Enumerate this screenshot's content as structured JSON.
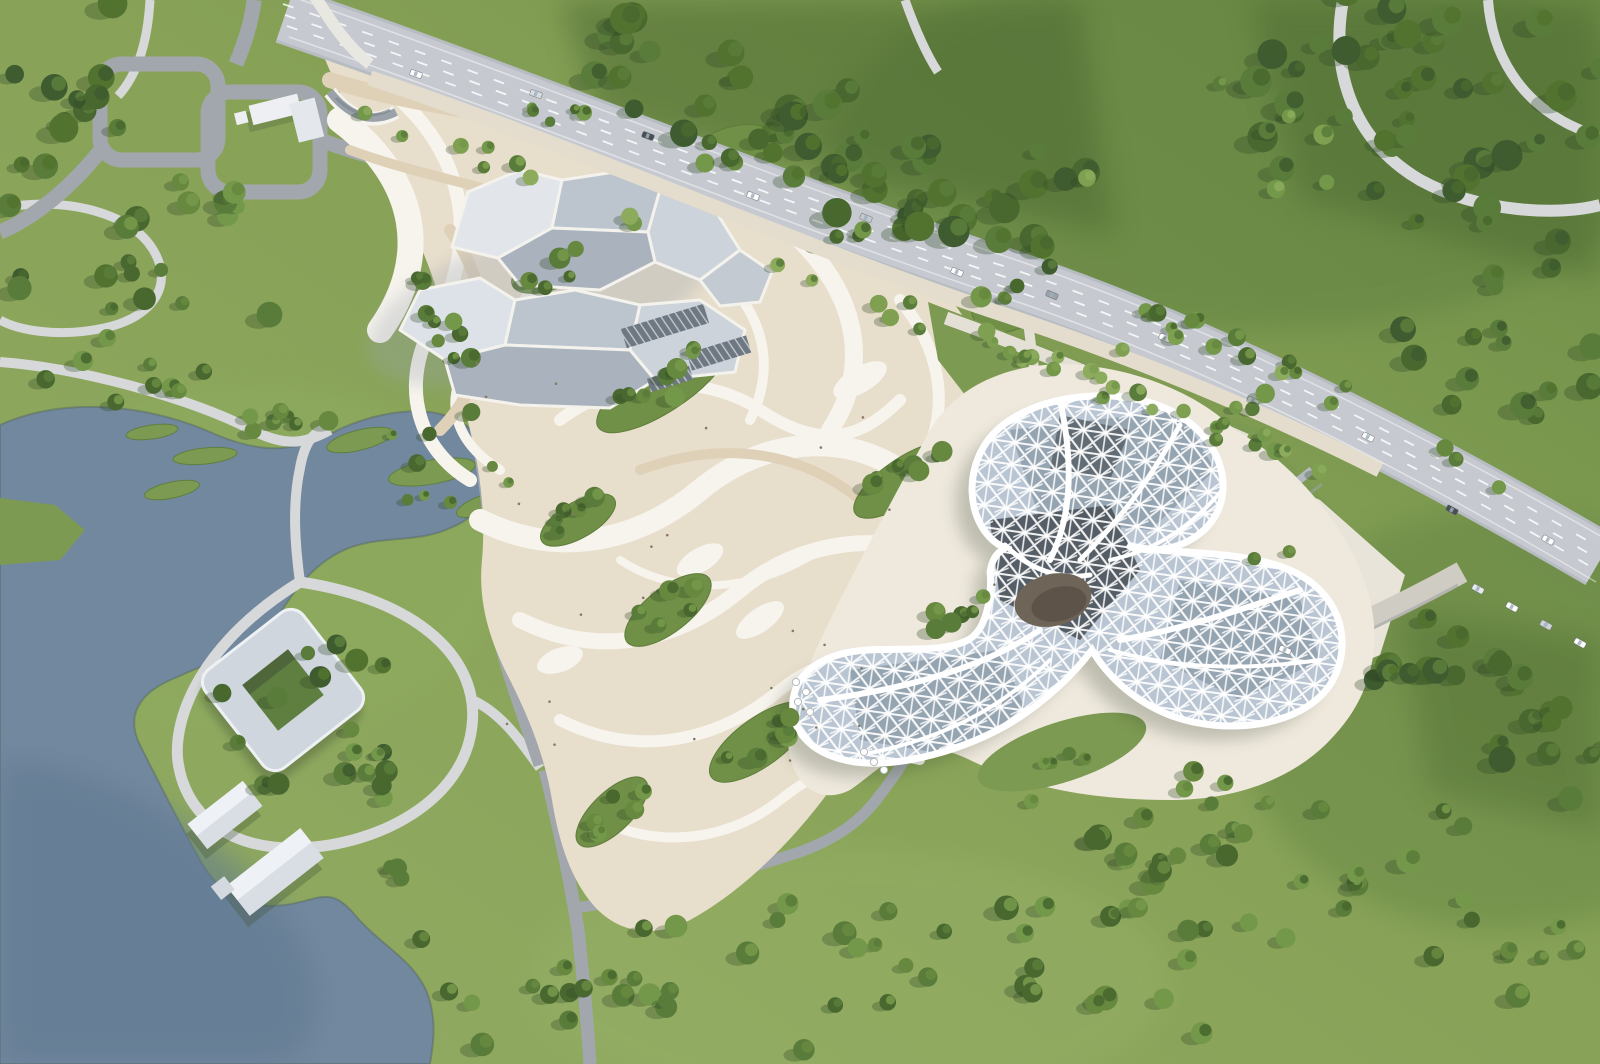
{
  "scene": {
    "type": "aerial-architectural-rendering",
    "description": "Bird's-eye masterplan rendering: park with lake and winding paths on the left, swirling cream-and-white plaza with rock-like grey pavilions in the centre, a white lattice-roof flower-shaped building on the right, and a tree-lined highway crossing diagonally with dense forest beyond.",
    "text_content": "none — image contains no readable text, labels or UI"
  },
  "colors": {
    "grass_base": "#87a257",
    "grass_light": "#9ab36a",
    "grass_dark": "#7d9a52",
    "meadow_dark": "#5f8040",
    "forest_floor": "#46632f",
    "tree_dark": "#48682f",
    "tree_mid": "#5a7c3b",
    "tree_light": "#74984a",
    "tree_pale": "#8cab5c",
    "tree_shadow": "#2f4526",
    "water": "#72889e",
    "water_deep": "#5f7890",
    "highway": "#c6cad0",
    "highway_casing": "#b7bcc2",
    "lane_marking": "#ffffff",
    "asphalt": "#a2a7ad",
    "path_light": "#d6d8d9",
    "sidewalk_cream": "#e4ddcd",
    "plaza_cream": "#e8decc",
    "plaza_tan": "#dfd1b8",
    "plaza_white": "#f7f4ed",
    "pavilion_top": "#e2e6eb",
    "pavilion_side": "#bcc4cd",
    "pavilion_shade": "#a9b2bd",
    "building_white": "#ffffff",
    "glass_base": "#b9c5d2",
    "glass_mid": "#8e9dac",
    "glass_dark": "#4a525a",
    "courtyard": "#6e6458",
    "apron_cream": "#efe9dd",
    "dropoff_pale": "#e9e4d9",
    "people_dot": "#857a68"
  },
  "scene_gen": {
    "seed": 7,
    "palettes": {
      "dark": [
        "#3e5c2f",
        "#48682f",
        "#52732f",
        "#5a7c3b"
      ],
      "mixed": [
        "#5a7c3b",
        "#48682f",
        "#74984a",
        "#67883f"
      ],
      "light": [
        "#74984a",
        "#8cab5c",
        "#5a7c3b",
        "#7ea050"
      ]
    },
    "tree_regions": [
      {
        "t": "band",
        "x1": 60,
        "y1": 0,
        "x2": 60,
        "y2": 300,
        "w": 120,
        "n": 16,
        "p": "dark",
        "r0": 8,
        "r1": 15
      },
      {
        "t": "blob",
        "cx": 200,
        "cy": 265,
        "rx": 95,
        "ry": 85,
        "n": 14,
        "p": "mixed",
        "r0": 7,
        "r1": 13
      },
      {
        "t": "band",
        "x1": 560,
        "y1": 50,
        "x2": 1080,
        "y2": 230,
        "w": 130,
        "n": 52,
        "p": "dark",
        "r0": 8,
        "r1": 16
      },
      {
        "t": "blob",
        "cx": 1420,
        "cy": 110,
        "rx": 200,
        "ry": 130,
        "n": 40,
        "p": "dark",
        "r0": 8,
        "r1": 16
      },
      {
        "t": "blob",
        "cx": 1530,
        "cy": 330,
        "rx": 130,
        "ry": 95,
        "n": 18,
        "p": "dark",
        "r0": 8,
        "r1": 14
      },
      {
        "t": "blob",
        "cx": 1210,
        "cy": 140,
        "rx": 150,
        "ry": 90,
        "n": 7,
        "p": "light",
        "r0": 7,
        "r1": 11
      },
      {
        "t": "band",
        "x1": 1060,
        "y1": 262,
        "x2": 1560,
        "y2": 505,
        "w": 34,
        "n": 15,
        "p": "mixed",
        "r0": 6,
        "r1": 10
      },
      {
        "t": "band",
        "x1": 360,
        "y1": 112,
        "x2": 1330,
        "y2": 468,
        "w": 26,
        "n": 30,
        "p": "light",
        "r0": 5,
        "r1": 9
      },
      {
        "t": "band",
        "x1": 150,
        "y1": 398,
        "x2": 330,
        "y2": 432,
        "w": 30,
        "n": 9,
        "p": "mixed",
        "r0": 6,
        "r1": 10
      },
      {
        "t": "blob",
        "cx": 432,
        "cy": 470,
        "rx": 85,
        "ry": 42,
        "n": 8,
        "p": "mixed",
        "r0": 5,
        "r1": 9
      },
      {
        "t": "blob",
        "cx": 310,
        "cy": 718,
        "rx": 120,
        "ry": 88,
        "n": 13,
        "p": "dark",
        "r0": 7,
        "r1": 12
      },
      {
        "t": "band",
        "x1": 345,
        "y1": 725,
        "x2": 428,
        "y2": 955,
        "w": 44,
        "n": 10,
        "p": "mixed",
        "r0": 6,
        "r1": 11
      },
      {
        "t": "blob",
        "cx": 120,
        "cy": 358,
        "rx": 100,
        "ry": 52,
        "n": 8,
        "p": "mixed",
        "r0": 6,
        "r1": 11
      },
      {
        "t": "blob",
        "cx": 1200,
        "cy": 360,
        "rx": 130,
        "ry": 70,
        "n": 9,
        "p": "light",
        "r0": 6,
        "r1": 10
      },
      {
        "t": "blob",
        "cx": 1155,
        "cy": 805,
        "rx": 125,
        "ry": 60,
        "n": 10,
        "p": "mixed",
        "r0": 7,
        "r1": 12
      },
      {
        "t": "blob",
        "cx": 1255,
        "cy": 920,
        "rx": 330,
        "ry": 135,
        "n": 46,
        "p": "mixed",
        "r0": 7,
        "r1": 13
      },
      {
        "t": "band",
        "x1": 1390,
        "y1": 645,
        "x2": 1600,
        "y2": 800,
        "w": 110,
        "n": 24,
        "p": "dark",
        "r0": 8,
        "r1": 14
      },
      {
        "t": "blob",
        "cx": 780,
        "cy": 975,
        "rx": 165,
        "ry": 85,
        "n": 20,
        "p": "mixed",
        "r0": 7,
        "r1": 12
      },
      {
        "t": "blob",
        "cx": 520,
        "cy": 985,
        "rx": 105,
        "ry": 70,
        "n": 10,
        "p": "mixed",
        "r0": 7,
        "r1": 12
      },
      {
        "t": "band",
        "x1": 428,
        "y1": 255,
        "x2": 468,
        "y2": 415,
        "w": 34,
        "n": 10,
        "p": "mixed",
        "r0": 6,
        "r1": 10
      },
      {
        "t": "blob",
        "cx": 565,
        "cy": 120,
        "rx": 42,
        "ry": 26,
        "n": 5,
        "p": "mixed",
        "r0": 5,
        "r1": 9
      },
      {
        "t": "blob",
        "cx": 1065,
        "cy": 748,
        "rx": 52,
        "ry": 20,
        "n": 4,
        "p": "mixed",
        "r0": 5,
        "r1": 8
      },
      {
        "t": "blob",
        "cx": 1268,
        "cy": 560,
        "rx": 40,
        "ry": 18,
        "n": 2,
        "p": "mixed",
        "r0": 5,
        "r1": 7
      },
      {
        "t": "band",
        "x1": 975,
        "y1": 332,
        "x2": 1235,
        "y2": 448,
        "w": 16,
        "n": 8,
        "p": "light",
        "r0": 5,
        "r1": 8
      }
    ],
    "plaza_leaves": [
      {
        "cx": 555,
        "cy": 268,
        "rx": 46,
        "ry": 20,
        "rot": -22,
        "n": 5
      },
      {
        "cx": 662,
        "cy": 386,
        "rx": 76,
        "ry": 26,
        "rot": -33,
        "n": 8
      },
      {
        "cx": 578,
        "cy": 520,
        "rx": 42,
        "ry": 18,
        "rot": -30,
        "n": 5
      },
      {
        "cx": 668,
        "cy": 610,
        "rx": 52,
        "ry": 22,
        "rot": -38,
        "n": 6
      },
      {
        "cx": 760,
        "cy": 742,
        "rx": 60,
        "ry": 24,
        "rot": -36,
        "n": 7
      },
      {
        "cx": 612,
        "cy": 812,
        "rx": 46,
        "ry": 20,
        "rot": -44,
        "n": 6
      },
      {
        "cx": 905,
        "cy": 480,
        "rx": 60,
        "ry": 22,
        "rot": -34,
        "n": 7
      },
      {
        "cx": 948,
        "cy": 622,
        "rx": 50,
        "ry": 20,
        "rot": -40,
        "n": 6
      },
      {
        "cx": 1010,
        "cy": 302,
        "rx": 40,
        "ry": 28,
        "rot": -24,
        "n": 5
      },
      {
        "cx": 730,
        "cy": 152,
        "rx": 46,
        "ry": 24,
        "rot": -20,
        "n": 5
      },
      {
        "cx": 838,
        "cy": 232,
        "rx": 38,
        "ry": 18,
        "rot": -22,
        "n": 3
      }
    ],
    "cars": [
      {
        "x": 416,
        "y": 74,
        "a": 19,
        "c": "#ffffff"
      },
      {
        "x": 536,
        "y": 94,
        "a": 19,
        "c": "#d9dde1"
      },
      {
        "x": 648,
        "y": 136,
        "a": 20,
        "c": "#4a4f55"
      },
      {
        "x": 753,
        "y": 196,
        "a": 21,
        "c": "#ffffff"
      },
      {
        "x": 866,
        "y": 218,
        "a": 21,
        "c": "#c3c8cd"
      },
      {
        "x": 957,
        "y": 272,
        "a": 22,
        "c": "#ffffff"
      },
      {
        "x": 1052,
        "y": 295,
        "a": 23,
        "c": "#9aa1a8"
      },
      {
        "x": 1165,
        "y": 338,
        "a": 25,
        "c": "#ffffff"
      },
      {
        "x": 1253,
        "y": 401,
        "a": 26,
        "c": "#d9dde1"
      },
      {
        "x": 1368,
        "y": 437,
        "a": 28,
        "c": "#ffffff"
      },
      {
        "x": 1452,
        "y": 510,
        "a": 29,
        "c": "#4a4f55"
      },
      {
        "x": 1548,
        "y": 540,
        "a": 29,
        "c": "#ffffff"
      },
      {
        "x": 1478,
        "y": 589,
        "a": 29,
        "c": "#e8eaec"
      },
      {
        "x": 1512,
        "y": 607,
        "a": 29,
        "c": "#ffffff"
      },
      {
        "x": 1546,
        "y": 625,
        "a": 29,
        "c": "#cfd3d7"
      },
      {
        "x": 1580,
        "y": 643,
        "a": 29,
        "c": "#ffffff"
      },
      {
        "x": 1285,
        "y": 650,
        "a": 23,
        "c": "#ffffff"
      }
    ],
    "umbrellas": [
      {
        "x": 796,
        "y": 682
      },
      {
        "x": 806,
        "y": 692
      },
      {
        "x": 798,
        "y": 702
      },
      {
        "x": 810,
        "y": 712
      },
      {
        "x": 864,
        "y": 752
      },
      {
        "x": 874,
        "y": 762
      },
      {
        "x": 884,
        "y": 770
      }
    ],
    "people_dots": [
      {
        "cx": 660,
        "cy": 520,
        "rx": 240,
        "ry": 300,
        "n": 18
      },
      {
        "cx": 900,
        "cy": 610,
        "rx": 150,
        "ry": 150,
        "n": 8
      }
    ]
  }
}
